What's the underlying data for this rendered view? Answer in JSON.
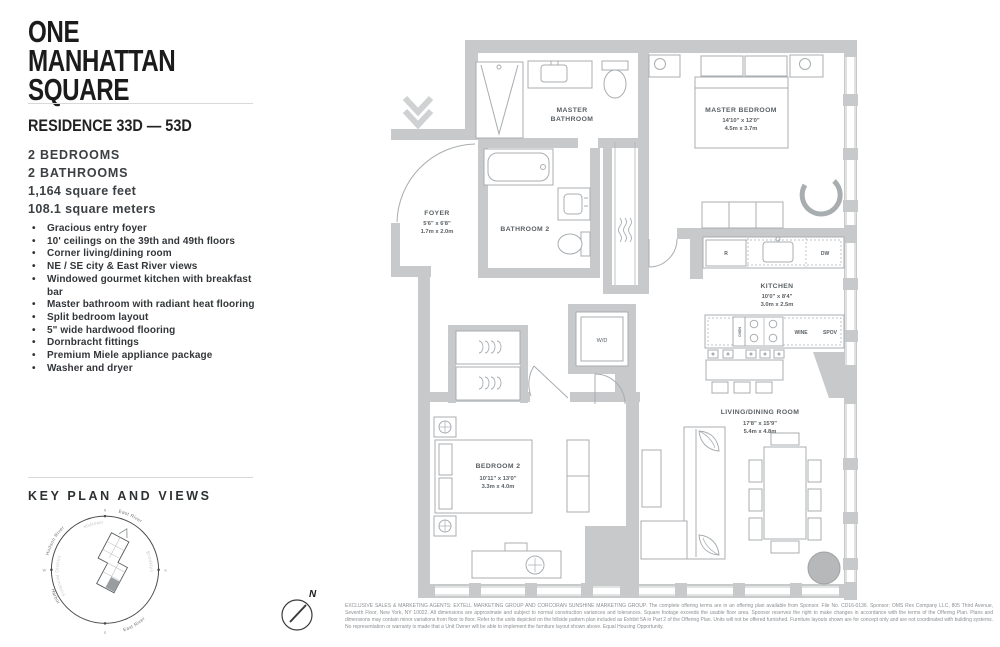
{
  "brand": {
    "line1": "ONE",
    "line2": "MANHATTAN",
    "line3": "SQUARE"
  },
  "sidebar": {
    "residence_title": "RESIDENCE 33D — 53D",
    "bedrooms": "2 BEDROOMS",
    "bathrooms": "2 BATHROOMS",
    "area_ft": "1,164 square feet",
    "area_m": "108.1 square meters",
    "features": [
      "Gracious entry foyer",
      "10' ceilings on the 39th and 49th floors",
      "Corner living/dining room",
      "NE / SE city & East River views",
      "Windowed gourmet kitchen with breakfast bar",
      "Master bathroom with radiant heat flooring",
      "Split bedroom layout",
      "5\" wide hardwood flooring",
      "Dornbracht fittings",
      "Premium Miele appliance package",
      "Washer and dryer"
    ],
    "key_plan_title": "KEY PLAN AND VIEWS"
  },
  "key_plan": {
    "labels": {
      "hudson_river": "Hudson River",
      "midtown": "Midtown",
      "east_river_ne": "East River",
      "brooklyn": "Brooklyn",
      "east_river_se": "East River",
      "harbor": "Harbor",
      "financial_district": "Financial District"
    },
    "compass": {
      "n": "N",
      "e": "E",
      "s": "S",
      "w": "W"
    }
  },
  "floor_plan": {
    "rooms": {
      "master_bathroom": {
        "line1": "MASTER",
        "line2": "BATHROOM"
      },
      "master_bedroom": {
        "name": "MASTER BEDROOM",
        "dim_ft": "14'10\" x 12'0\"",
        "dim_m": "4.5m x 3.7m"
      },
      "foyer": {
        "name": "FOYER",
        "dim_ft": "5'6\" x 6'8\"",
        "dim_m": "1.7m x 2.0m"
      },
      "bathroom_2": {
        "name": "BATHROOM 2"
      },
      "kitchen": {
        "name": "KITCHEN",
        "dim_ft": "10'0\" x 8'4\"",
        "dim_m": "3.0m x 2.5m"
      },
      "bedroom_2": {
        "name": "BEDROOM 2",
        "dim_ft": "10'11\" x 13'0\"",
        "dim_m": "3.3m x 4.0m"
      },
      "living_dining": {
        "name": "LIVING/DINING ROOM",
        "dim_ft": "17'8\" x 15'9\"",
        "dim_m": "5.4m x 4.8m"
      },
      "laundry": "W/D"
    },
    "appliances": {
      "refrigerator": "R",
      "dishwasher": "DW",
      "wine": "WINE",
      "speed_oven": "SPOV",
      "oven": "OVEN"
    },
    "compass_n": "N"
  },
  "footer": {
    "disclaimer": "EXCLUSIVE SALES & MARKETING AGENTS: EXTELL MARKETING GROUP AND CORCORAN SUNSHINE MARKETING GROUP. The complete offering terms are in an offering plan available from Sponsor. File No. CD16-0136. Sponsor: OMS Rex Company LLC, 805 Third Avenue, Seventh Floor, New York, NY 10022. All dimensions are approximate and subject to normal construction variances and tolerances. Square footage exceeds the usable floor area. Sponsor reserves the right to make changes in accordance with the terms of the Offering Plan. Plans and dimensions may contain minor variations from floor to floor. Refer to the units depicted on the hillside pattern plan included as Exhibit 5A in Part 2 of the Offering Plan. Units will not be offered furnished. Furniture layouts shown are for concept only and are not coordinated with building systems. No representation or warranty is made that a Unit Owner will be able to implement the furniture layout shown above. Equal Housing Opportunity."
  },
  "colors": {
    "wall": "#c8c9ca",
    "line": "#a8adb0",
    "label_text": "#595f63",
    "logo": "#1b1b1b",
    "column": "#b7b8b9"
  }
}
